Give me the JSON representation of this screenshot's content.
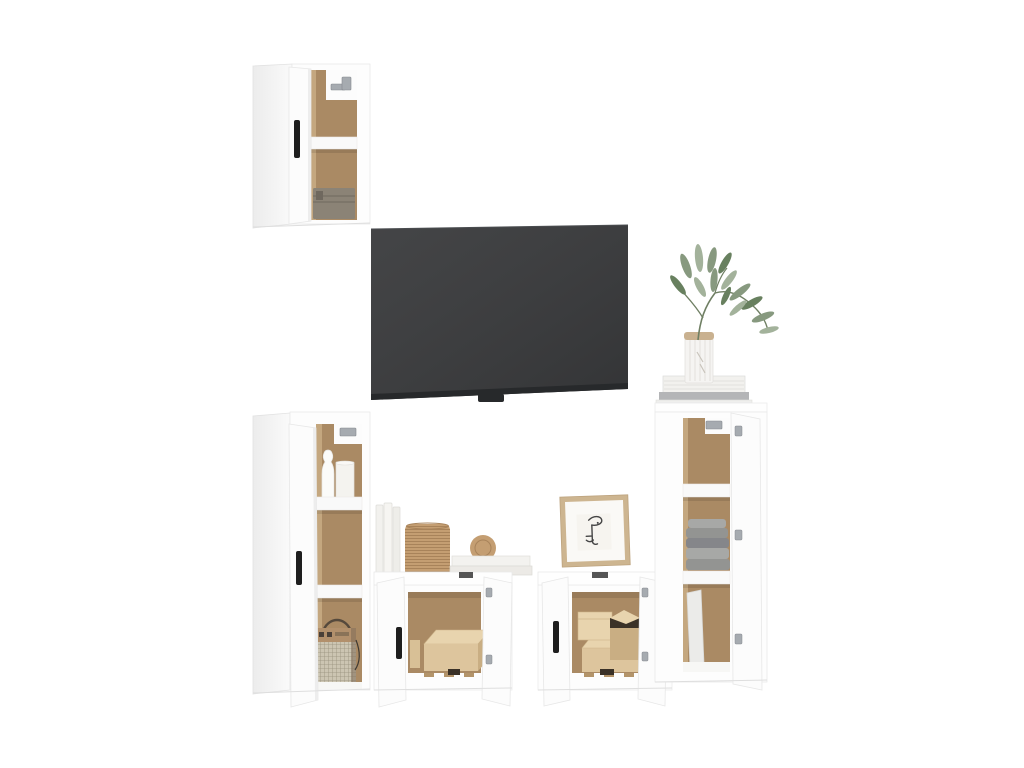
{
  "scene": {
    "width": 1024,
    "height": 768,
    "background": "#ffffff",
    "subject": "five-piece-white-tv-cabinet-set-product-photo"
  },
  "palette": {
    "cabinet_white": "#fdfdfd",
    "cabinet_side": "#f2f2f2",
    "cabinet_edge": "#e6e6e6",
    "interior_back": "#aa8a64",
    "interior_wall": "#c4a77f",
    "interior_shadow": "rgba(0,0,0,0.10)",
    "tv_screen": "#38393b",
    "tv_bezel": "#27292b",
    "handle_black": "#1e1e1e",
    "hinge_metal": "#a6abb0",
    "basket_gray": "#8b8376",
    "basket_gray_line": "#6f685e",
    "wicker_tan": "#c49e72",
    "wicker_line": "#a8835a",
    "box_beige": "#ddc59d",
    "box_beige_light": "#e8d4ae",
    "box_beige_dark": "#c9ae83",
    "box_opening": "#3a3127",
    "pallet_wood": "#b3946a",
    "towel_gray": "#939492",
    "towel_gray_light": "#a7a8a6",
    "towel_gray_dark": "#85868a",
    "radio_wood": "#b2906c",
    "radio_mesh": "#ccc5b2",
    "radio_dark": "#55493c",
    "plant_green": "#87997f",
    "plant_green_dark": "#68805f",
    "plant_green_light": "#a3b29b",
    "stem_green": "#6f7f63",
    "vase_white": "#f5f4f2",
    "vase_rim": "#c9b190",
    "frame_wood": "#cdb590",
    "frame_mat": "#faf9f6",
    "art_line": "#454545",
    "book_white": "#f2f1ee",
    "book_gray": "#b4b5b7",
    "panel_lean": "#ebebe9"
  },
  "objects": {
    "wall_cabinet_top": "open wall cabinet with shelf and gray box",
    "tv": "wall-mounted flat screen tv",
    "plant": "green sprig in striped vase on book stack",
    "tall_cabinet_left": "open tall cabinet with vase, candle and retro radio",
    "low_cabinet_left": "open low cabinet with beige storage box",
    "low_cabinet_right": "open low cabinet with beige boxes",
    "tall_cabinet_right": "open tall cabinet with folded gray towels",
    "decor_books": "leaning white books",
    "decor_basket": "round wicker basket",
    "decor_frame": "framed one-line face drawing"
  }
}
